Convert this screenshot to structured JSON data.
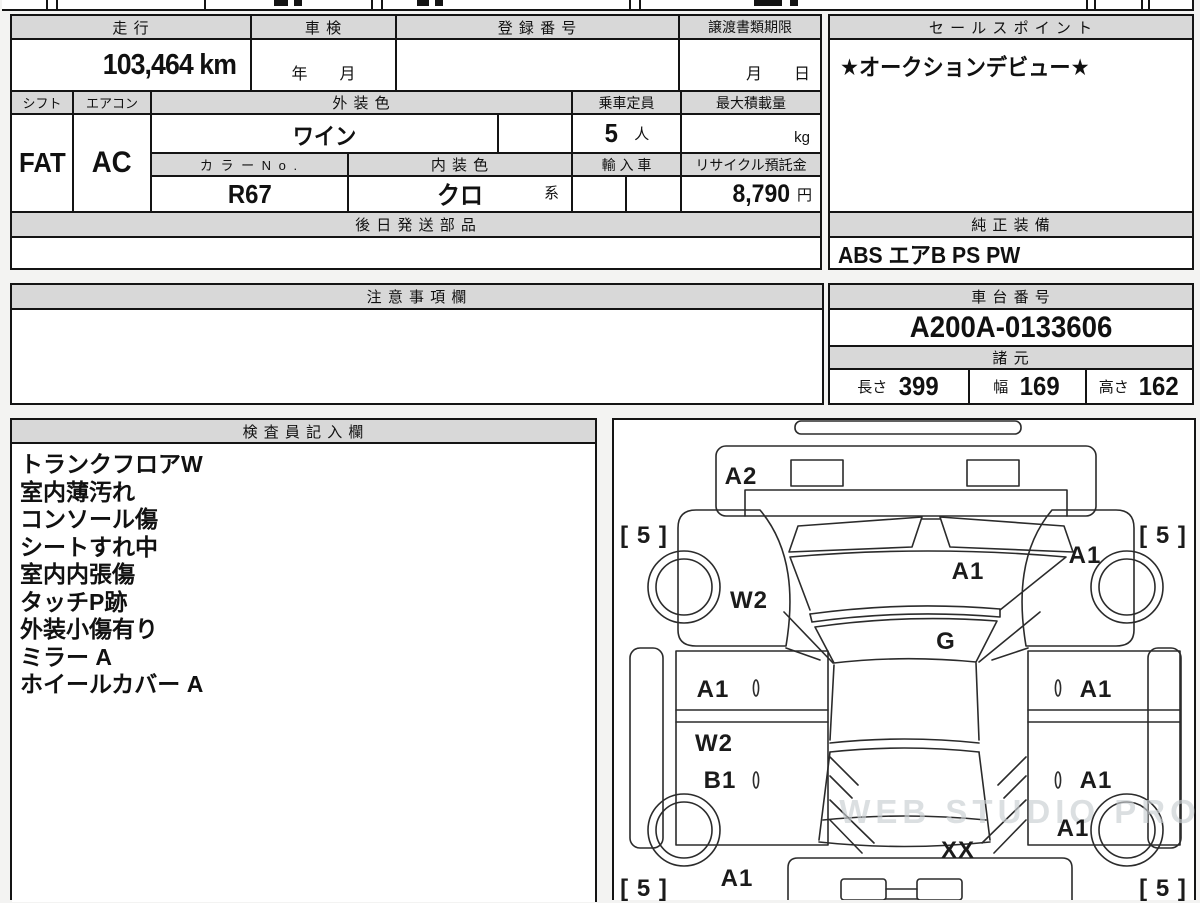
{
  "colors": {
    "header_bg": "#d8d8d8",
    "border": "#141414",
    "cell_bg": "#ffffff",
    "watermark": "#c9ced2"
  },
  "top_table": {
    "mileage_label": "走 行",
    "mileage_value": "103,464 km",
    "inspection_label": "車 検",
    "inspection_value": "年　　月",
    "registration_label": "登 録 番 号",
    "registration_value": "",
    "transfer_docs_label": "譲渡書類期限",
    "transfer_docs_value": "月　　日"
  },
  "spec_table": {
    "shift_label": "シフト",
    "shift_value": "FAT",
    "aircon_label": "エアコン",
    "aircon_value": "AC",
    "exterior_color_label": "外 装 色",
    "exterior_color_value": "ワイン",
    "capacity_label": "乗車定員",
    "capacity_value": "5",
    "capacity_unit": "人",
    "max_load_label": "最大積載量",
    "max_load_value": "",
    "max_load_unit": "kg",
    "color_no_label": "カ ラ ー N o .",
    "color_no_value": "R67",
    "interior_color_label": "内 装 色",
    "interior_color_value": "クロ",
    "interior_color_suffix": "系",
    "import_label": "輸 入 車",
    "import_value": "",
    "recycle_label": "リサイクル預託金",
    "recycle_value": "8,790",
    "recycle_unit": "円",
    "later_shipping_label": "後 日 発 送 部 品",
    "later_shipping_value": ""
  },
  "sales_point": {
    "label": "セ ー ル ス ポ イ ン ト",
    "value": "★オークションデビュー★"
  },
  "equipment": {
    "label": "純 正 装 備",
    "value": "ABS エアB PS PW"
  },
  "notes": {
    "label": "注 意 事 項 欄",
    "value": ""
  },
  "chassis": {
    "label": "車 台 番 号",
    "value": "A200A-0133606"
  },
  "dimensions": {
    "label": "諸 元",
    "length_label": "長さ",
    "length_value": "399",
    "width_label": "幅",
    "width_value": "169",
    "height_label": "高さ",
    "height_value": "162"
  },
  "inspector": {
    "label": "検 査 員 記 入 欄",
    "lines": [
      "トランクフロアW",
      "室内薄汚れ",
      "コンソール傷",
      "シートすれ中",
      "室内内張傷",
      "タッチP跡",
      "外装小傷有り",
      "ミラー A",
      "ホイールカバー A"
    ]
  },
  "diagram": {
    "watermark": "WEB STUDIO PRO",
    "labels": [
      {
        "text": "A2",
        "x": 741,
        "y": 477
      },
      {
        "text": "[ 5 ]",
        "x": 644,
        "y": 536
      },
      {
        "text": "[ 5 ]",
        "x": 1163,
        "y": 536
      },
      {
        "text": "A1",
        "x": 1085,
        "y": 556
      },
      {
        "text": "A1",
        "x": 968,
        "y": 572
      },
      {
        "text": "W2",
        "x": 749,
        "y": 601
      },
      {
        "text": "G",
        "x": 946,
        "y": 642
      },
      {
        "text": "A1",
        "x": 713,
        "y": 690
      },
      {
        "text": "A1",
        "x": 1096,
        "y": 690
      },
      {
        "text": "W2",
        "x": 714,
        "y": 744
      },
      {
        "text": "B1",
        "x": 720,
        "y": 781
      },
      {
        "text": "A1",
        "x": 1096,
        "y": 781
      },
      {
        "text": "A1",
        "x": 1073,
        "y": 829
      },
      {
        "text": "XX",
        "x": 958,
        "y": 851
      },
      {
        "text": "A1",
        "x": 737,
        "y": 879
      },
      {
        "text": "[ 5 ]",
        "x": 644,
        "y": 889
      },
      {
        "text": "[ 5 ]",
        "x": 1163,
        "y": 889
      }
    ]
  }
}
